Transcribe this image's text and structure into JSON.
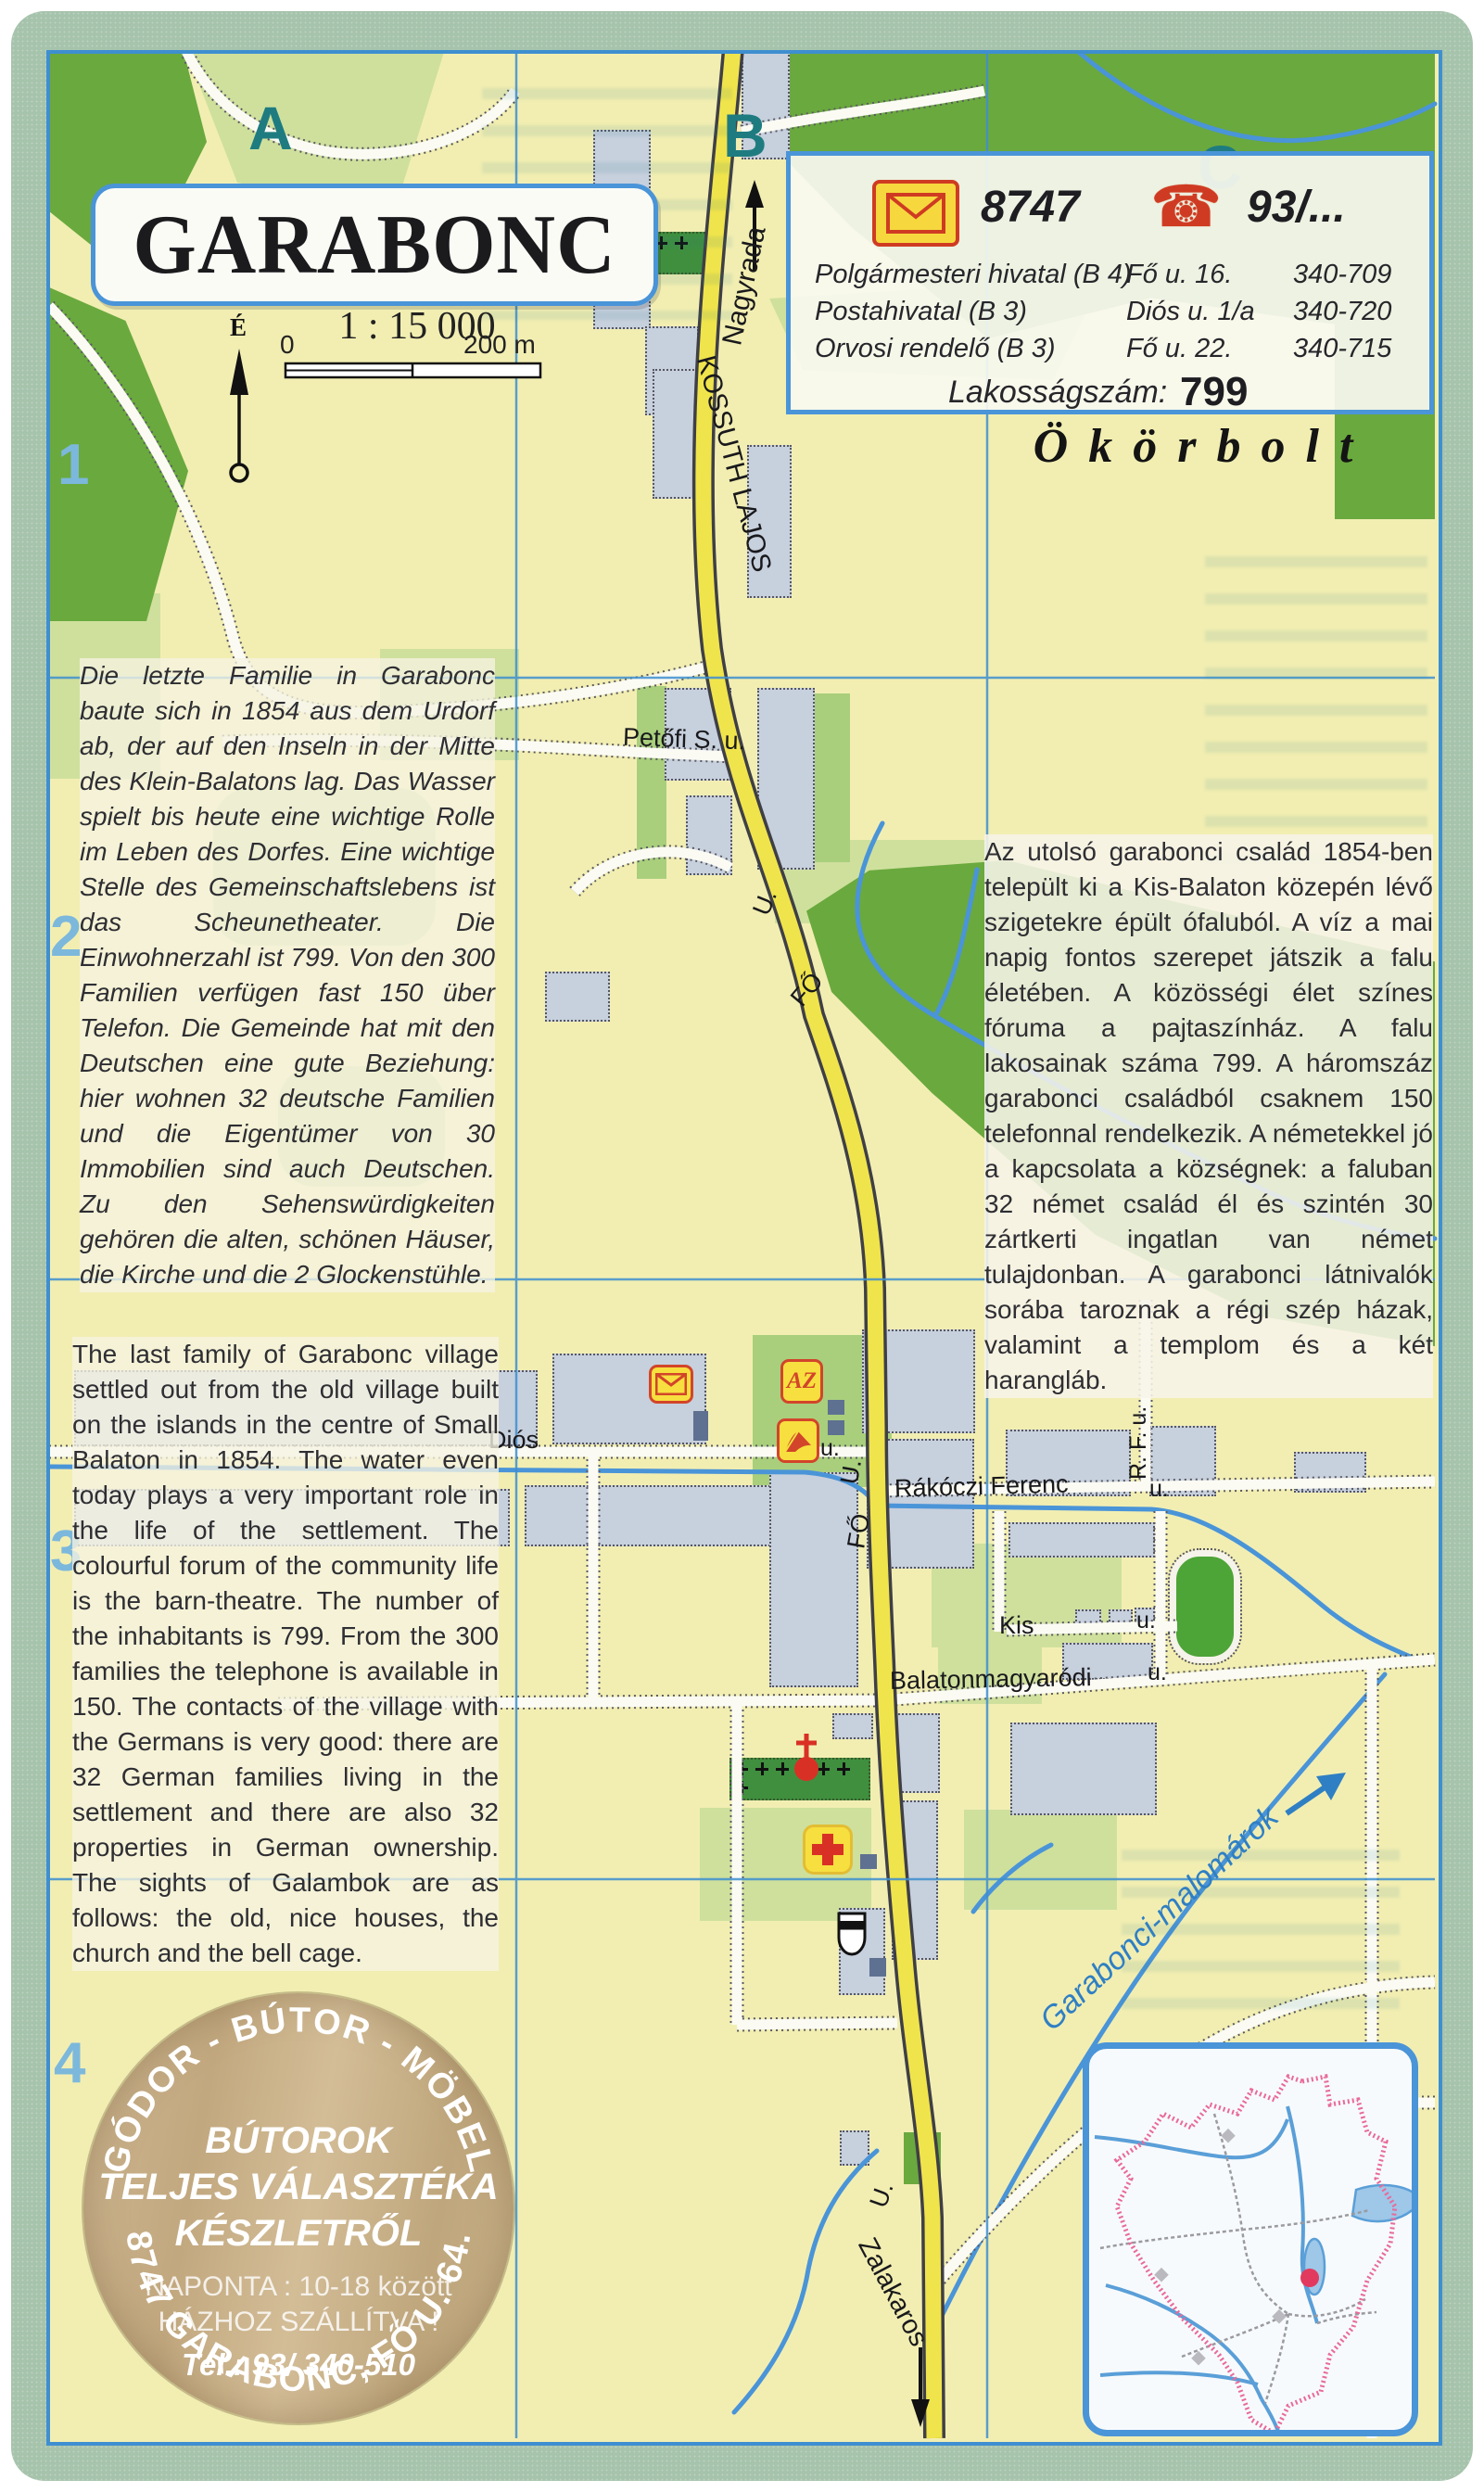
{
  "title_box": {
    "title": "GARABONC",
    "scale": "1 : 15 000",
    "scale_start": "0",
    "scale_end": "200 m",
    "north_letter": "É"
  },
  "grid": {
    "columns": [
      "A",
      "B",
      "C"
    ],
    "rows": [
      "1",
      "2",
      "3",
      "4"
    ]
  },
  "info_box": {
    "postal_code": "8747",
    "phone_code": "93/...",
    "rows": [
      {
        "name": "Polgármesteri hivatal (B 4)",
        "address": "Fő u. 16.",
        "phone": "340-709"
      },
      {
        "name": "Postahivatal (B 3)",
        "address": "Diós u. 1/a",
        "phone": "340-720"
      },
      {
        "name": "Orvosi rendelő (B 3)",
        "address": "Fő u. 22.",
        "phone": "340-715"
      }
    ],
    "population_label": "Lakosságszám:",
    "population_value": "799"
  },
  "shop_note": "Ökörbolt",
  "articles": {
    "german": "Die letzte Familie in Garabonc baute sich in 1854 aus dem Urdorf ab, der auf den Inseln in der Mitte des Klein-Balatons lag. Das Wasser spielt bis heute eine wichtige Rolle im Leben des Dorfes. Eine wichtige Stelle des Gemeinschaftslebens ist das Scheunetheater. Die Einwohnerzahl ist 799. Von den 300 Familien verfügen fast 150 über Telefon. Die Gemeinde hat mit den Deutschen eine gute Beziehung: hier wohnen 32 deutsche Familien und die Eigentümer von 30 Immobilien sind auch Deutschen. Zu den Sehenswürdigkeiten gehören die alten, schönen Häuser, die Kirche und die 2 Glockenstühle.",
    "english": "The last family of Garabonc village settled out from the old village built on the islands in the centre of Small Balaton in 1854. The water even today plays a very important role in the life of the settlement. The colourful forum of the community life is the barn-theatre. The number of the inhabitants is 799. From the 300 families the telephone is available in 150. The contacts of the village with the Germans is very good: there are 32 German families living in the settlement and there are also 32 properties in German ownership. The sights of Galambok are as follows: the old, nice houses, the church and the bell cage.",
    "hungarian": "Az utolsó garabonci család 1854-ben települt ki a Kis-Balaton közepén lévő szigetekre épült ófaluból. A víz a mai napig fontos szerepet játszik a falu életében. A közösségi élet színes fóruma a pajtaszínház. A falu lakosainak száma 799. A háromszáz garabonci családból csaknem 150 telefonnal rendelkezik. A németekkel jó a kapcsolata a községnek: a faluban 32 német család él és szintén 30 zártkerti ingatlan van német tulajdonban. A garabonci látnivalók sorába taroznak a régi szép házak, valamint a templom és a két harangláb."
  },
  "streets": {
    "nagyrada": "Nagyrada",
    "kossuth": "KOSSUTH LAJOS",
    "petofi": "Petőfi S. u.",
    "dios": "Diós",
    "dios_u": "u.",
    "fo_mid_u": "U.",
    "fo_mid": "FŐ",
    "fo_low_u": "U.",
    "fo_low": "FŐ",
    "fo_bottom_u": "U.",
    "rakoczi": "Rákóczi Ferenc",
    "rakoczi_u": "u.",
    "rf": "R. F. u.",
    "kis": "Kis",
    "kis_u": "u.",
    "balatonmagyarodi": "Balatonmagyaródi",
    "balatonmagyarodi_u": "u.",
    "zalakaros": "Zalakaros"
  },
  "water": {
    "canal": "Garabonci-malomárok"
  },
  "map_icons": {
    "shop_letters": "AZ",
    "post_office": "envelope-icon",
    "library": "open-book-icon",
    "pharmacy": "red-cross-icon",
    "church": "church-icon",
    "monument": "bell-cage-icon"
  },
  "ad_circle": {
    "arc_top": "GÓDOR - BÚTOR - MÖBEL",
    "line1": "BÚTOROK",
    "line2": "TELJES VÁLASZTÉKA",
    "line3": "KÉSZLETRŐL",
    "line4": "NAPONTA : 10-18 között",
    "line5": "HÁZHOZ SZÁLLÍTVA !",
    "tel": "Tel.: 93/ 340-510",
    "arc_bottom": "8747 GARABONC, FŐ U. 64."
  },
  "colors": {
    "frame_green": "#a6c3ac",
    "grid_blue": "#3e8fd0",
    "road_yellow": "#f0e44c",
    "forest_green": "#6aa93e",
    "built_up": "#c7d0dd",
    "water_blue": "#4a94d8",
    "grid_letter_teal": "#1e7c80",
    "row_number_blue": "#7cb8dc",
    "icon_yellow": "#f7df3f",
    "icon_red": "#d2452a",
    "ad_tan": "#c8b28c"
  }
}
